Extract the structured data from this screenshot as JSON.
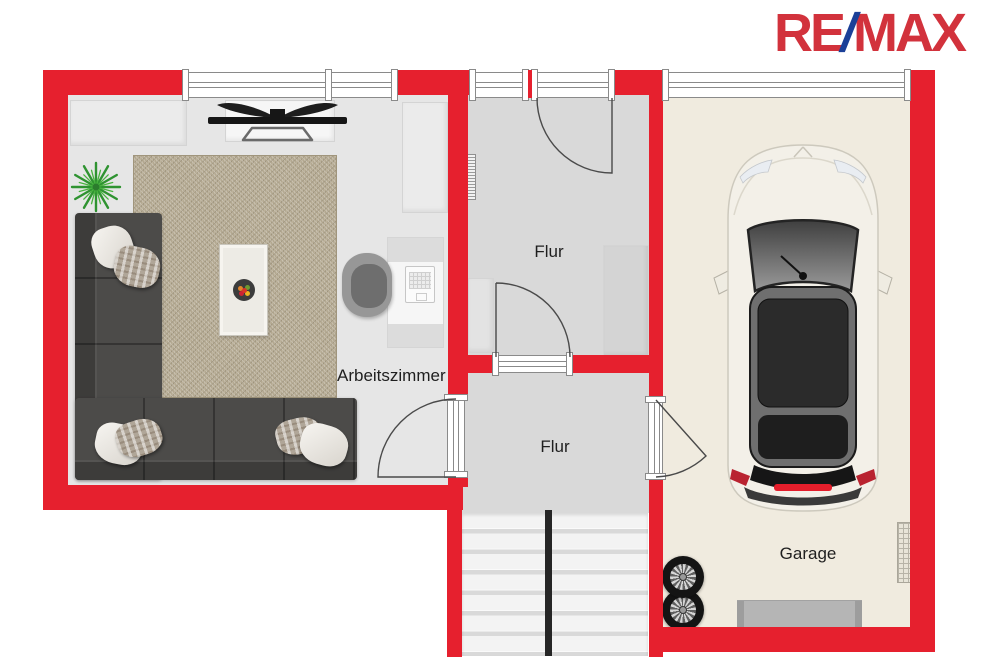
{
  "logo": {
    "re": "RE",
    "slash": "/",
    "max": "MAX"
  },
  "labels": {
    "arbeitszimmer": "Arbeitszimmer",
    "flur_top": "Flur",
    "flur_bottom": "Flur",
    "garage": "Garage"
  },
  "colors": {
    "wall_red": "#e6202e",
    "logo_red": "#d2323c",
    "logo_blue": "#1b4098",
    "floor_living": "#e6e6e6",
    "floor_flur": "#d9d9d9",
    "floor_garage": "#f0ebdf",
    "rug": "#b3a890",
    "sofa": "#4c4b49",
    "label_text": "#1f1f1f"
  },
  "icons": {
    "plant": "potted-plant-top-view",
    "tv": "tv-top-view",
    "sofa": "corner-sofa-top-view",
    "car": "car-top-view",
    "tires": "spare-tires",
    "stairs": "staircase"
  }
}
